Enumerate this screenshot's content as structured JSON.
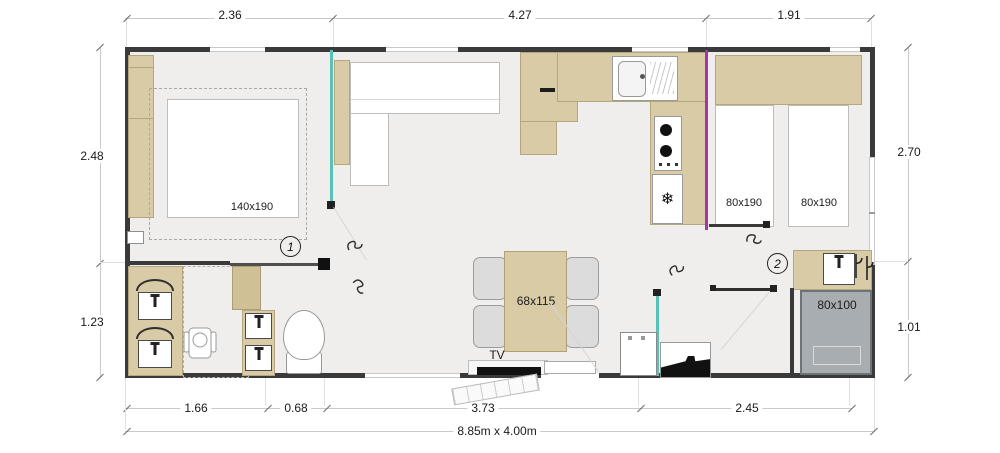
{
  "dimensions": {
    "top": [
      "2.36",
      "4.27",
      "1.91"
    ],
    "left": [
      "2.48",
      "1.23"
    ],
    "right": [
      "2.70",
      "1.01"
    ],
    "bottom": [
      "1.66",
      "0.68",
      "3.73",
      "2.45"
    ],
    "overall": "8.85m x 4.00m"
  },
  "furniture": {
    "master_bed": "140x190",
    "twin_bed_left": "80x190",
    "twin_bed_right": "80x190",
    "dining_table": "68x115",
    "shower": "80x100",
    "tv": "TV"
  },
  "doors": {
    "door_1": "1",
    "door_2": "2"
  },
  "icons": {
    "fridge_snowflake": "❄"
  },
  "colors": {
    "wall": "#3a3a3a",
    "floor": "#efeeec",
    "wood": "#d8cba6",
    "partition_teal": "#57c2b5",
    "partition_purple": "#a735a7",
    "shower_gray": "#a7adb0"
  }
}
